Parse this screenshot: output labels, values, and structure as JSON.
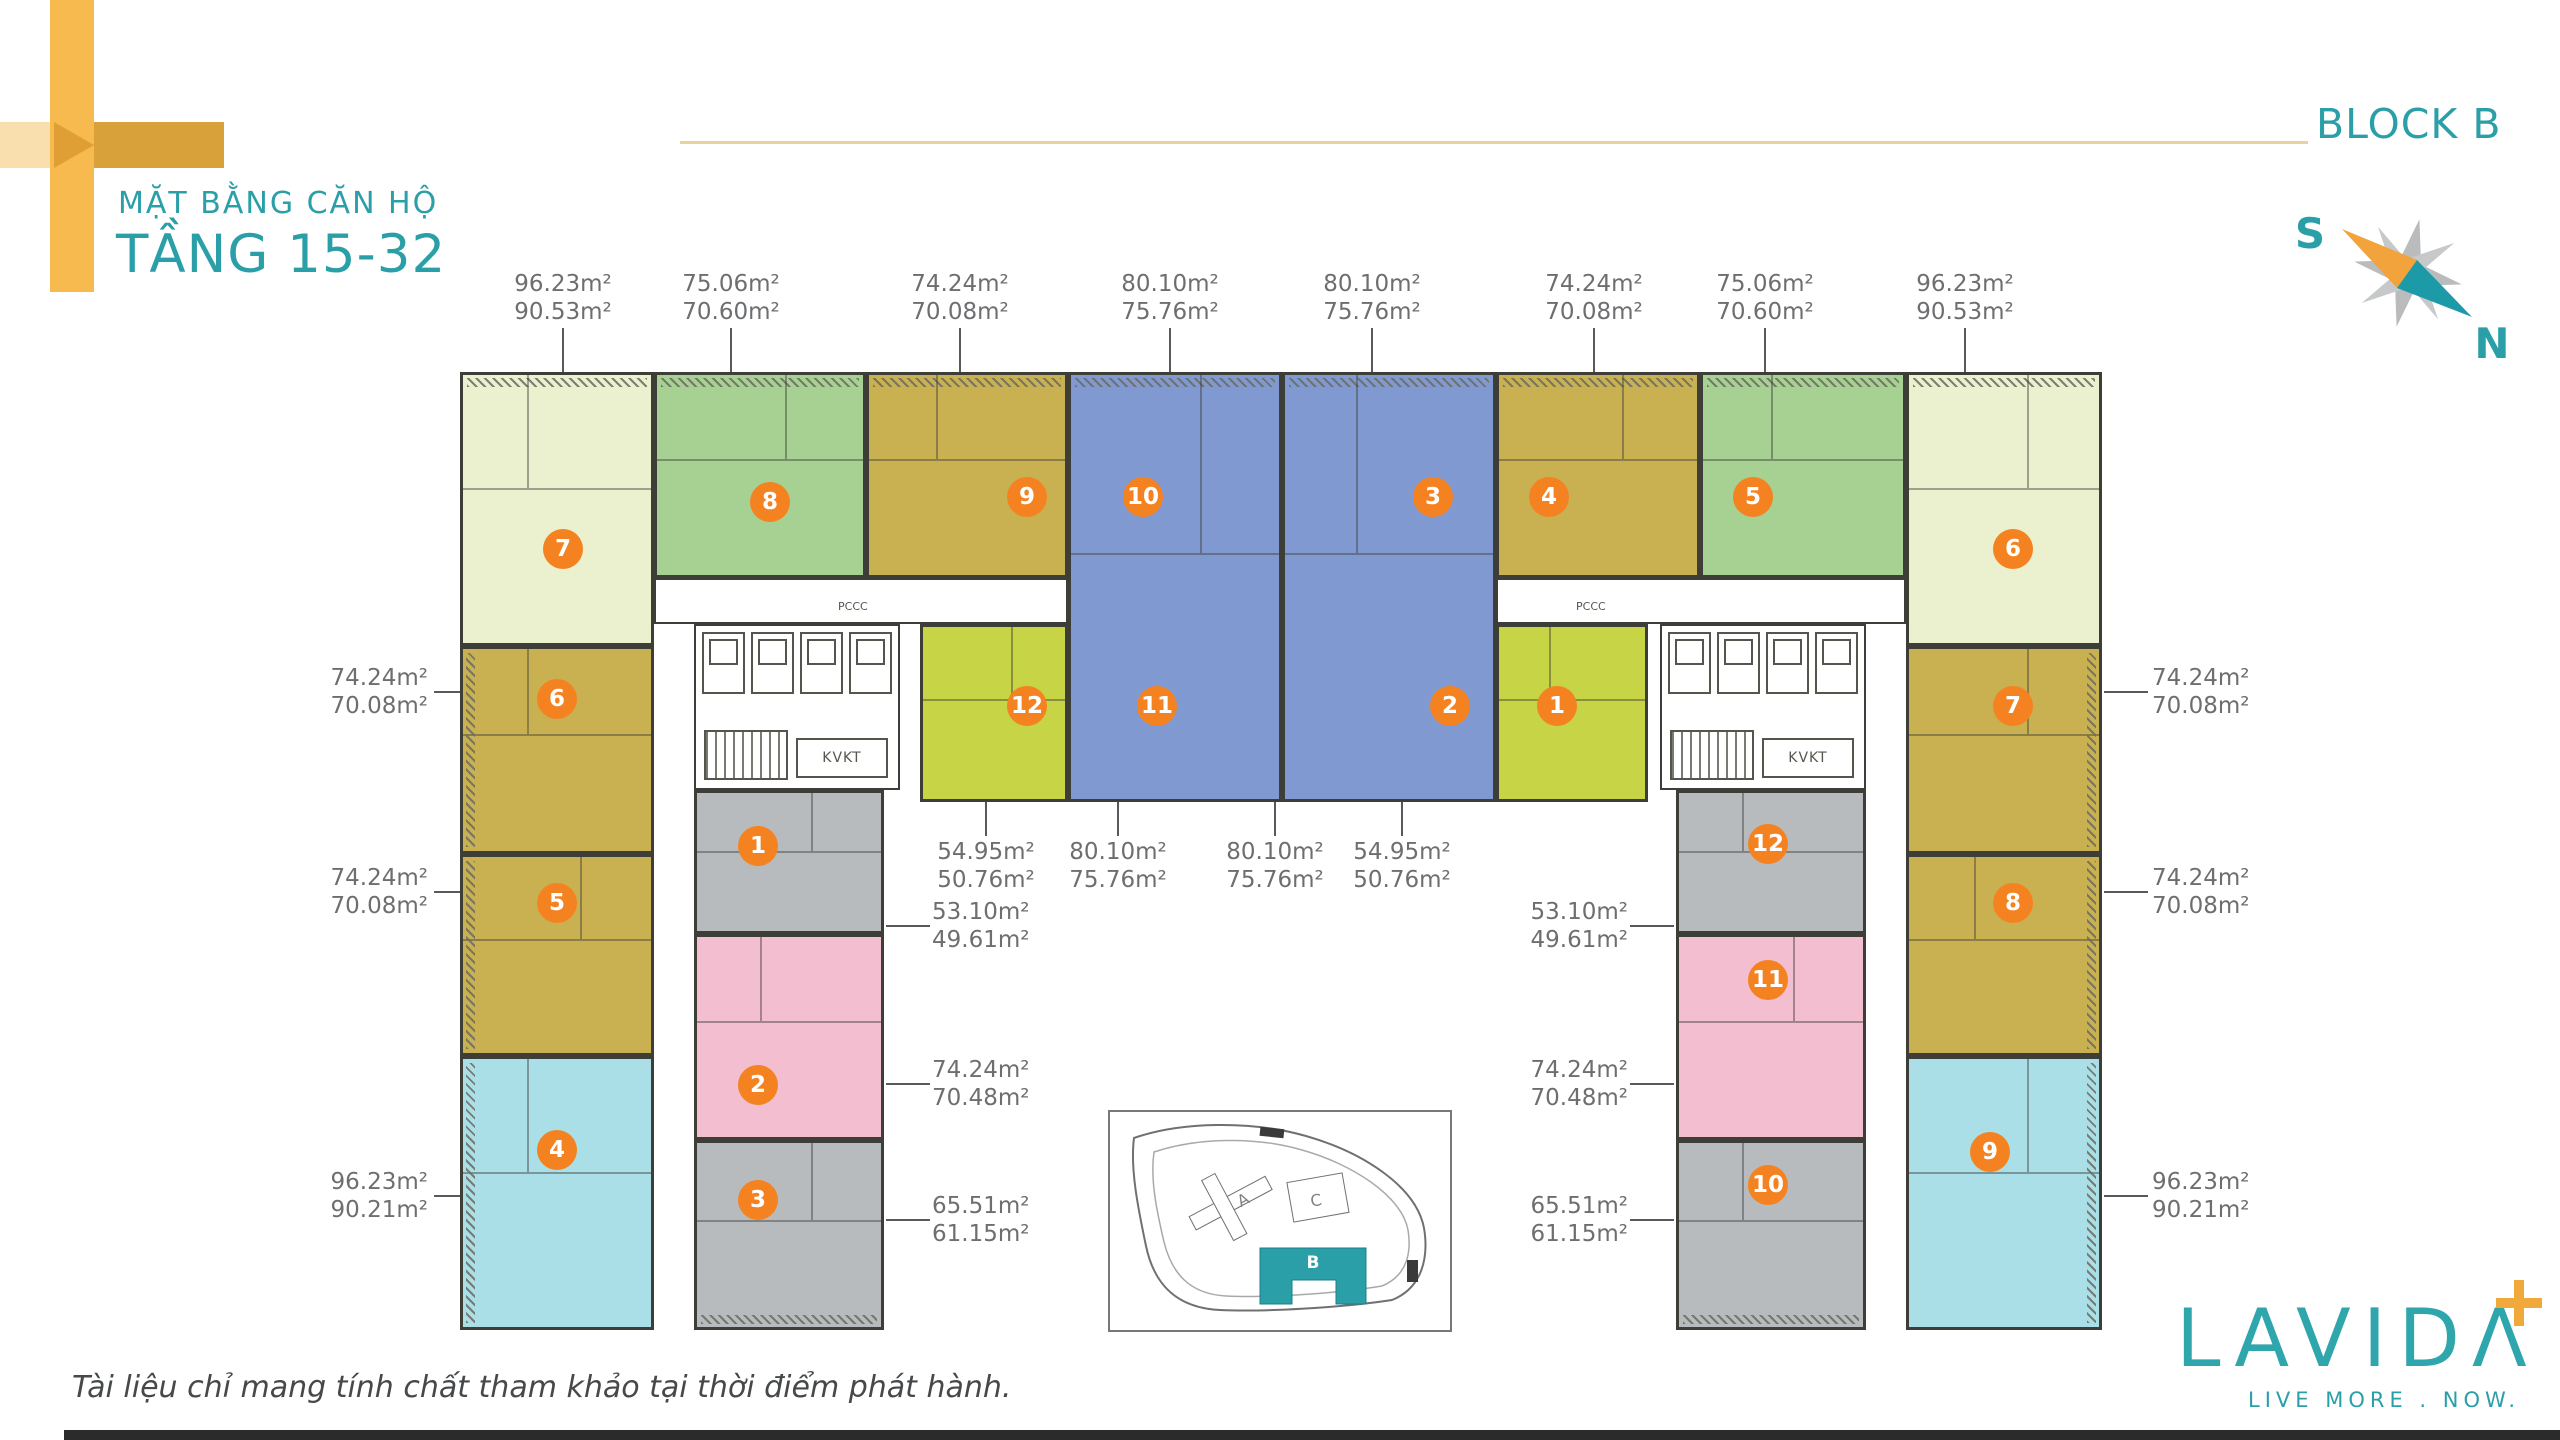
{
  "header": {
    "title_line1": "MẶT BẰNG CĂN HỘ",
    "title_line2": "TẦNG 15-32",
    "block_label": "BLOCK B"
  },
  "compass": {
    "south": "S",
    "north": "N"
  },
  "badges": [
    "7",
    "8",
    "9",
    "10",
    "3",
    "4",
    "5",
    "6",
    "12",
    "11",
    "2",
    "1",
    "6",
    "5",
    "4",
    "1",
    "2",
    "3",
    "7",
    "8",
    "9",
    "12",
    "11",
    "10"
  ],
  "labels": {
    "top": [
      {
        "a": "96.23m²",
        "b": "90.53m²"
      },
      {
        "a": "75.06m²",
        "b": "70.60m²"
      },
      {
        "a": "74.24m²",
        "b": "70.08m²"
      },
      {
        "a": "80.10m²",
        "b": "75.76m²"
      },
      {
        "a": "80.10m²",
        "b": "75.76m²"
      },
      {
        "a": "74.24m²",
        "b": "70.08m²"
      },
      {
        "a": "75.06m²",
        "b": "70.60m²"
      },
      {
        "a": "96.23m²",
        "b": "90.53m²"
      }
    ],
    "left": [
      {
        "a": "74.24m²",
        "b": "70.08m²"
      },
      {
        "a": "74.24m²",
        "b": "70.08m²"
      },
      {
        "a": "96.23m²",
        "b": "90.21m²"
      }
    ],
    "right": [
      {
        "a": "74.24m²",
        "b": "70.08m²"
      },
      {
        "a": "74.24m²",
        "b": "70.08m²"
      },
      {
        "a": "96.23m²",
        "b": "90.21m²"
      }
    ],
    "mid": [
      {
        "a": "54.95m²",
        "b": "50.76m²"
      },
      {
        "a": "80.10m²",
        "b": "75.76m²"
      },
      {
        "a": "80.10m²",
        "b": "75.76m²"
      },
      {
        "a": "54.95m²",
        "b": "50.76m²"
      }
    ],
    "inner_left": [
      {
        "a": "53.10m²",
        "b": "49.61m²"
      },
      {
        "a": "74.24m²",
        "b": "70.48m²"
      },
      {
        "a": "65.51m²",
        "b": "61.15m²"
      }
    ],
    "inner_right": [
      {
        "a": "53.10m²",
        "b": "49.61m²"
      },
      {
        "a": "74.24m²",
        "b": "70.48m²"
      },
      {
        "a": "65.51m²",
        "b": "61.15m²"
      }
    ]
  },
  "core": {
    "kvkt": "KVKT",
    "pccc": "PCCC"
  },
  "sitemap": {
    "block_a": "A",
    "block_b": "B",
    "block_c": "C"
  },
  "logo": {
    "wordmark": "LAVIDΛ",
    "tagline": "LIVE MORE . NOW."
  },
  "disclaimer": "Tài liệu chỉ mang tính chất tham khảo tại thời điểm phát hành.",
  "colors": {
    "teal": "#2B9FA8",
    "badge_orange": "#F58220",
    "cross_main": "#F6BA4F",
    "cross_dark": "#D9A13A",
    "cross_light": "#FADFAE",
    "pale": "#EBF0CF",
    "green": "#A6D192",
    "olive": "#C9B152",
    "blue": "#8099D1",
    "lime": "#C6D446",
    "gray": "#B8BBBD",
    "pink": "#F2BED0",
    "cyan": "#ABDFE7"
  }
}
